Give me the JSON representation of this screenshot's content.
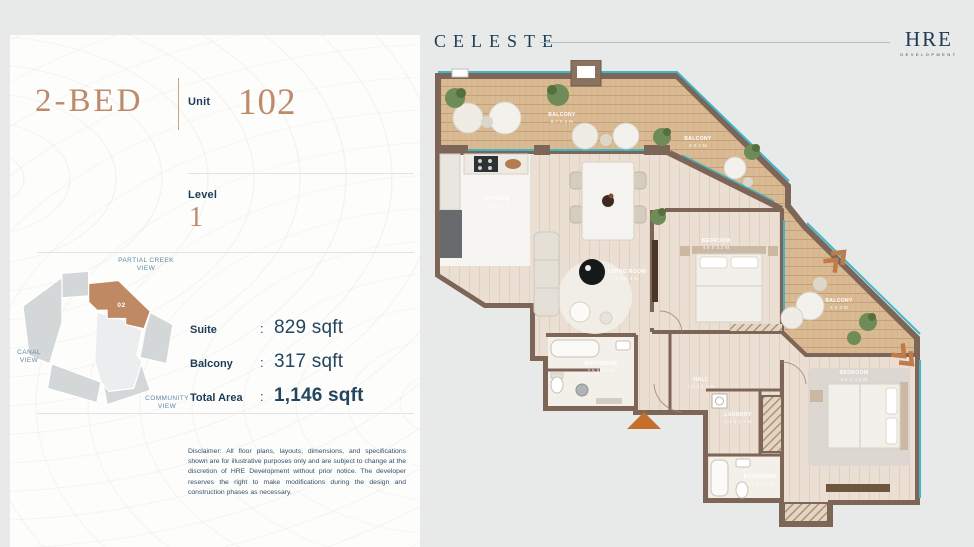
{
  "header": {
    "brand": "CELESTE",
    "developer_name": "HRE",
    "developer_subtitle": "DEVELOPMENT"
  },
  "card": {
    "unit_type": "2-BED",
    "unit_label": "Unit",
    "unit_number": "102",
    "level_label": "Level",
    "level_value": "1",
    "colon": ":",
    "specs": [
      {
        "label": "Suite",
        "value": "829 sqft"
      },
      {
        "label": "Balcony",
        "value": "317 sqft"
      },
      {
        "label": "Total Area",
        "value": "1,146 sqft"
      }
    ],
    "keyplan": {
      "unit_tag": "02",
      "view_labels": {
        "top": "PARTIAL CREEK VIEW",
        "left": "CANAL VIEW",
        "bottom": "COMMUNITY VIEW"
      }
    },
    "disclaimer": "Disclaimer: All floor plans, layouts, dimensions, and specifications shown are for illustrative purposes only and are subject to change at the discretion of HRE Development without prior notice. The developer reserves the right to make modifications during the design and construction phases as necessary."
  },
  "floorplan": {
    "rooms": [
      {
        "name": "BALCONY",
        "dims": "8.7 X 2 M"
      },
      {
        "name": "BALCONY",
        "dims": "2 X 2 M"
      },
      {
        "name": "KITCHEN",
        "dims": "2.6 X 2.2 M"
      },
      {
        "name": "LIVING ROOM",
        "dims": "4.5 X 4 M"
      },
      {
        "name": "BEDROOM",
        "dims": "4.5 X 3.2 M"
      },
      {
        "name": "BALCONY",
        "dims": "3 X 3 M"
      },
      {
        "name": "BATHROOM",
        "dims": "2.5 X 1.5 M"
      },
      {
        "name": "HALL",
        "dims": "1.2 X 1.1 M"
      },
      {
        "name": "LAUNDRY",
        "dims": "1.4 X 1.7 M"
      },
      {
        "name": "BEDROOM",
        "dims": "3.6 X 4.2 M"
      },
      {
        "name": "BATHROOM",
        "dims": "2.4 X 1.5 M"
      }
    ]
  },
  "colors": {
    "accent_tan": "#bd8a6a",
    "navy": "#1d3a52",
    "keyplan_highlight": "#bf8a63",
    "glass_teal": "#3fb5c7",
    "wall_brown": "#7d6557",
    "entrance_orange": "#c56f2b",
    "view_label_blue": "#6089a2"
  }
}
